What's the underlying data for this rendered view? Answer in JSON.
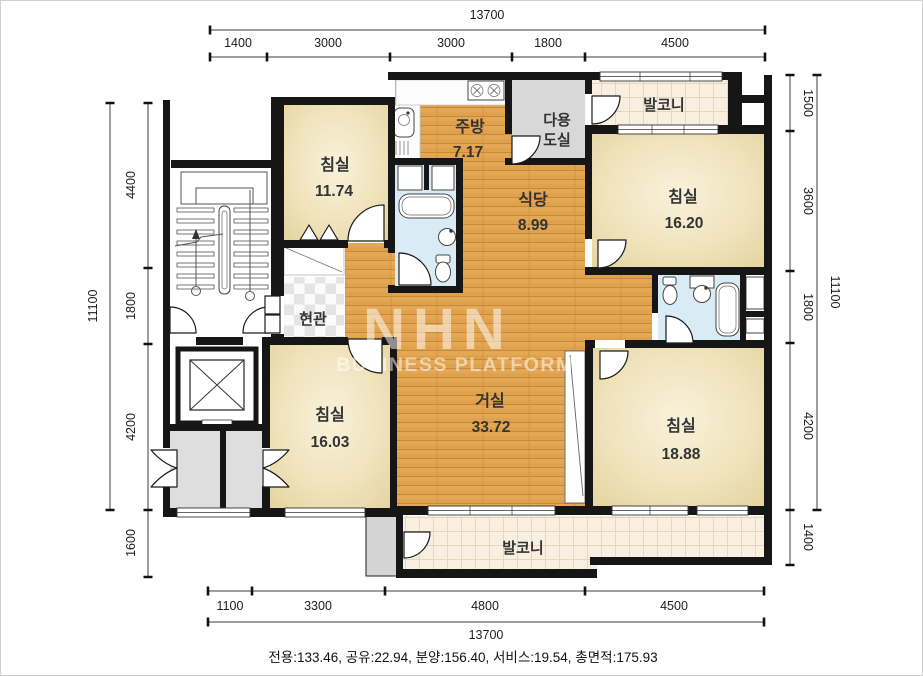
{
  "watermark": {
    "logo": "NHN",
    "subtitle": "BUSINESS PLATFORM"
  },
  "footer": {
    "area_summary": "전용:133.46, 공유:22.94, 분양:156.40, 서비스:19.54, 총면적:175.93"
  },
  "rooms": {
    "bedroom_top_left": {
      "name": "침실",
      "area": "11.74"
    },
    "kitchen": {
      "name": "주방",
      "area": "7.17"
    },
    "utility": {
      "name_line1": "다용",
      "name_line2": "도실"
    },
    "balcony_top": {
      "name": "발코니"
    },
    "bedroom_top_right": {
      "name": "침실",
      "area": "16.20"
    },
    "dining": {
      "name": "식당",
      "area": "8.99"
    },
    "entrance": {
      "name": "현관"
    },
    "living": {
      "name": "거실",
      "area": "33.72"
    },
    "bedroom_bottom_left": {
      "name": "침실",
      "area": "16.03"
    },
    "bedroom_bottom_right": {
      "name": "침실",
      "area": "18.88"
    },
    "balcony_bottom": {
      "name": "발코니"
    }
  },
  "dimensions": {
    "top": {
      "total": "13700",
      "segments": [
        "1400",
        "3000",
        "3000",
        "1800",
        "4500"
      ]
    },
    "bottom": {
      "total": "13700",
      "segments": [
        "1100",
        "3300",
        "4800",
        "4500"
      ]
    },
    "left": {
      "total": "11100",
      "segments": [
        "4400",
        "1800",
        "4200",
        "1600"
      ]
    },
    "right": {
      "total": "11100",
      "segments": [
        "1500",
        "3600",
        "1800",
        "4200",
        "1400"
      ]
    }
  }
}
